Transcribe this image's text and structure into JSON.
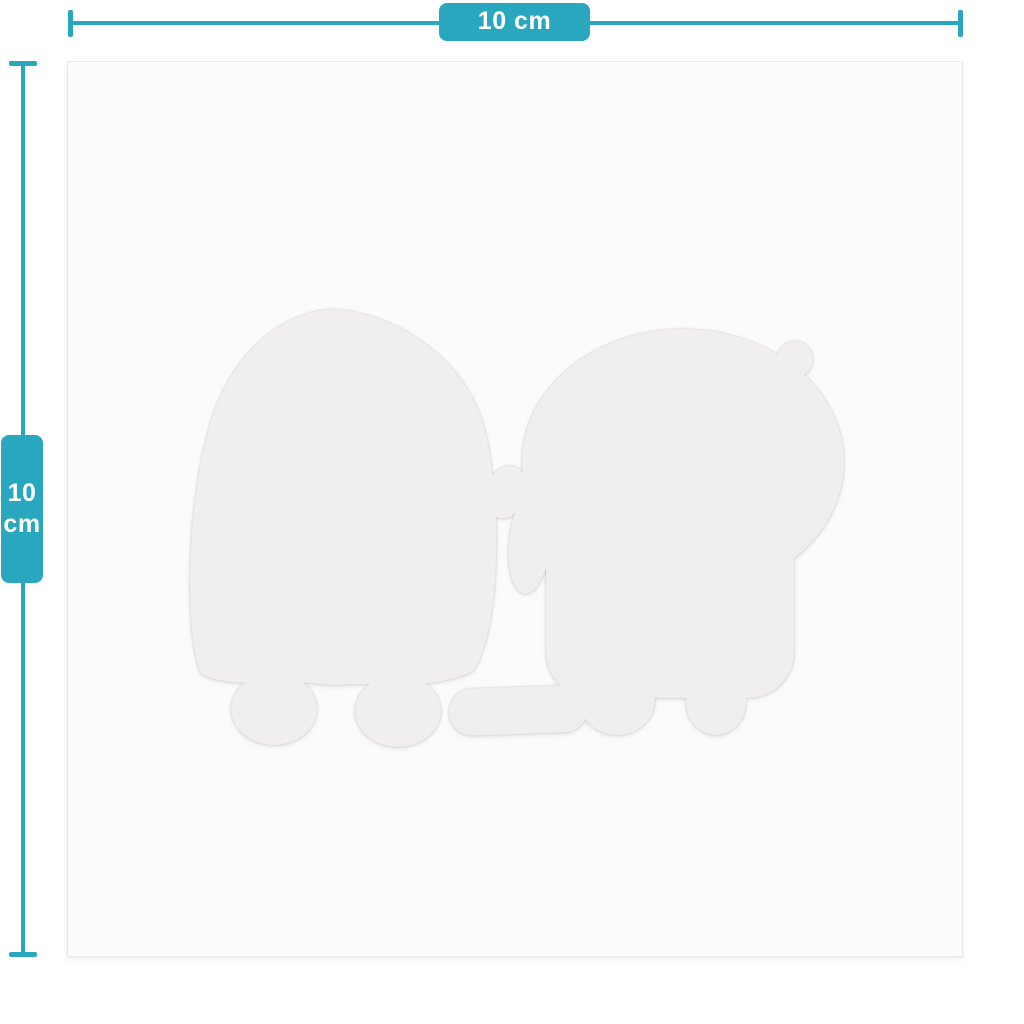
{
  "theme": {
    "accent": "#29a7be",
    "accent-text": "#ffffff",
    "page-bg": "#ffffff",
    "sheet-bg": "#fbfbfa",
    "sheet-edge": "#e9e9e7",
    "silhouette": "#f0efed"
  },
  "size_guide": {
    "width_dimension": {
      "label": "10 cm"
    },
    "height_dimension": {
      "value": "10",
      "unit": "cm"
    }
  },
  "sheet": {
    "description": "white square sticker sheet with faint die-cut character silhouettes",
    "figures": [
      "left-minion-silhouette",
      "right-minion-silhouette",
      "banana-silhouette"
    ]
  }
}
